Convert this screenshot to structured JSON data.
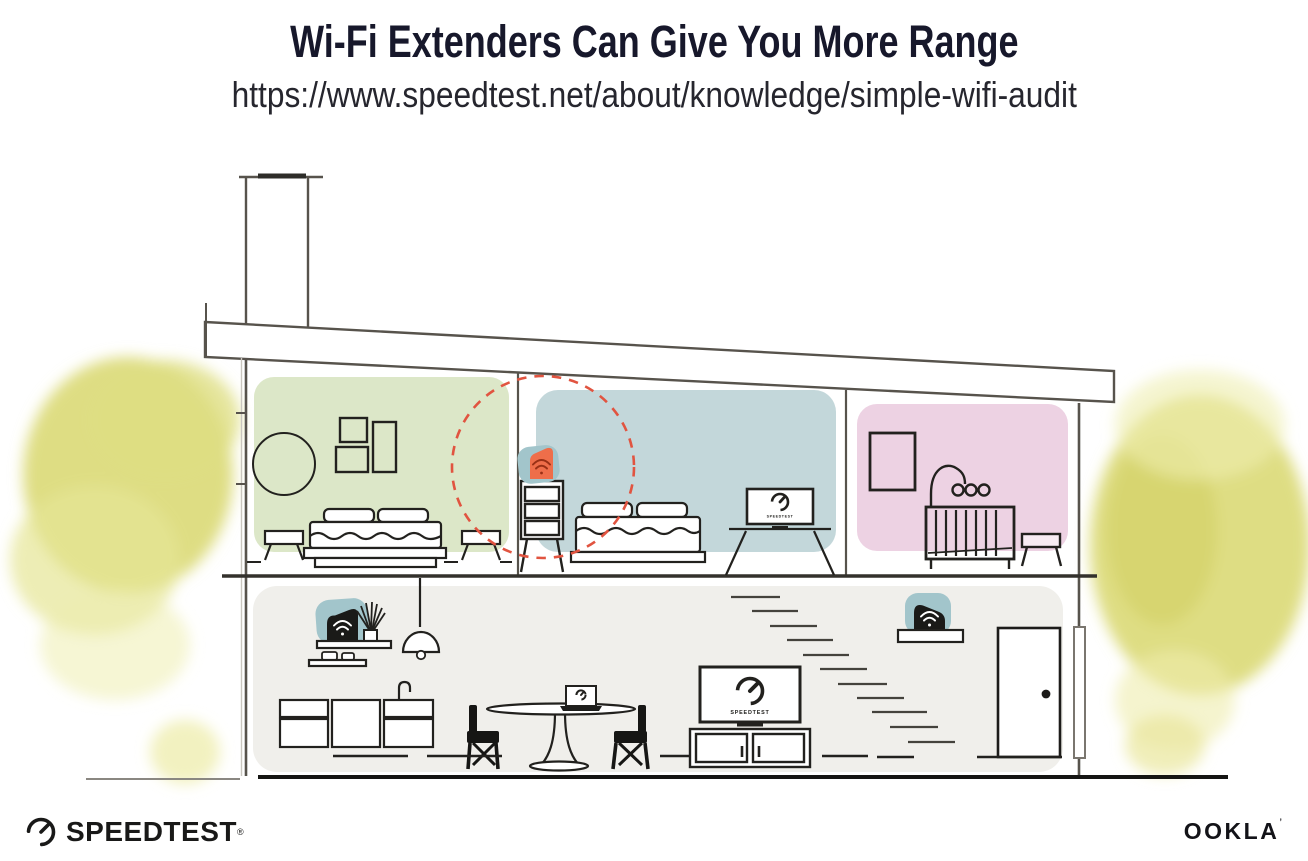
{
  "header": {
    "title": "Wi-Fi Extenders Can Give You More Range",
    "url": "https://www.speedtest.net/about/knowledge/simple-wifi-audit"
  },
  "footer": {
    "speedtest": {
      "label": "SPEEDTEST",
      "reg": "®"
    },
    "ookla": {
      "label": "OOKLA",
      "tick": "’"
    }
  },
  "illustration": {
    "screen_label": "SPEEDTEST",
    "rooms": [
      {
        "name": "bedroom-green"
      },
      {
        "name": "bedroom-blue"
      },
      {
        "name": "nursery-pink"
      },
      {
        "name": "living-kitchen"
      }
    ],
    "devices": [
      {
        "name": "wifi-extender-orange-upstairs"
      },
      {
        "name": "wifi-router-shelf-left"
      },
      {
        "name": "wifi-extender-shelf-right"
      }
    ],
    "colors": {
      "room_green": "#dce7c8",
      "room_blue": "#c3d7da",
      "room_pink": "#edd2e3",
      "floor_gray": "#f0efeb",
      "device_teal": "#a2c5cb",
      "extender_orange": "#ee6e4a",
      "wifi_dark_red": "#993016",
      "range_dashed_red": "#e15440",
      "foliage_yellow": "#dcdb7c",
      "foliage_yellow_light": "#efeeb0",
      "line_dark": "#22211e",
      "wall_gray": "#57534c",
      "title_navy": "#17182b"
    }
  }
}
